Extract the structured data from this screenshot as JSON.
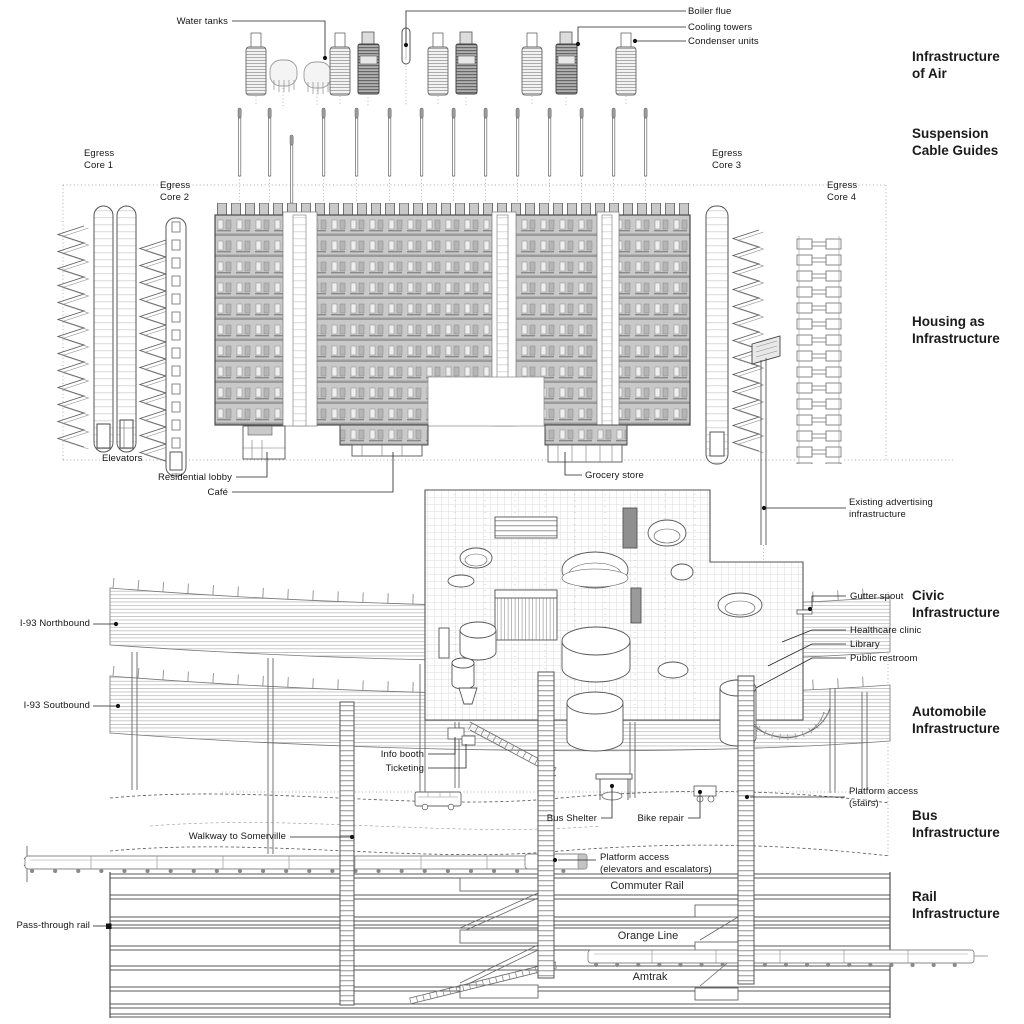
{
  "sections": [
    {
      "id": "infrastructure-of-air",
      "label": "Infrastructure\nof Air"
    },
    {
      "id": "suspension-cable-guides",
      "label": "Suspension\nCable Guides"
    },
    {
      "id": "housing-as-infrastructure",
      "label": "Housing as\nInfrastructure"
    },
    {
      "id": "civic-infrastructure",
      "label": "Civic\nInfrastructure"
    },
    {
      "id": "automobile-infrastructure",
      "label": "Automobile\nInfrastructure"
    },
    {
      "id": "bus-infrastructure",
      "label": "Bus\nInfrastructure"
    },
    {
      "id": "rail-infrastructure",
      "label": "Rail\nInfrastructure"
    }
  ],
  "callouts": {
    "water_tanks": "Water tanks",
    "boiler_flue": "Boiler flue",
    "cooling_towers": "Cooling towers",
    "condenser_units": "Condenser units",
    "egress_core_1": "Egress\nCore 1",
    "egress_core_2": "Egress\nCore 2",
    "egress_core_3": "Egress\nCore 3",
    "egress_core_4": "Egress\nCore 4",
    "elevators": "Elevators",
    "residential_lobby": "Residential lobby",
    "cafe": "Café",
    "grocery_store": "Grocery store",
    "existing_advertising": "Existing advertising\ninfrastructure",
    "gutter_spout": "Gutter spout",
    "healthcare_clinic": "Healthcare clinic",
    "library": "Library",
    "public_restroom": "Public restroom",
    "i93_northbound": "I-93 Northbound",
    "i93_southbound": "I-93 Soutbound",
    "info_booth": "Info booth",
    "ticketing": "Ticketing",
    "bus_shelter": "Bus Shelter",
    "bike_repair": "Bike repair",
    "platform_access_stairs": "Platform access\n(stairs)",
    "walkway_to_somerville": "Walkway to Somerville",
    "platform_access_elevators": "Platform access\n(elevators and escalators)",
    "pass_through_rail": "Pass-through rail"
  },
  "rail_labels": {
    "commuter_rail": "Commuter Rail",
    "orange_line": "Orange Line",
    "amtrak": "Amtrak"
  },
  "colors": {
    "ink": "#1a1a1a",
    "line": "#555555",
    "housing_fill": "#c9c9c9",
    "tower_dark": "#b0b0b0",
    "background": "#ffffff"
  }
}
